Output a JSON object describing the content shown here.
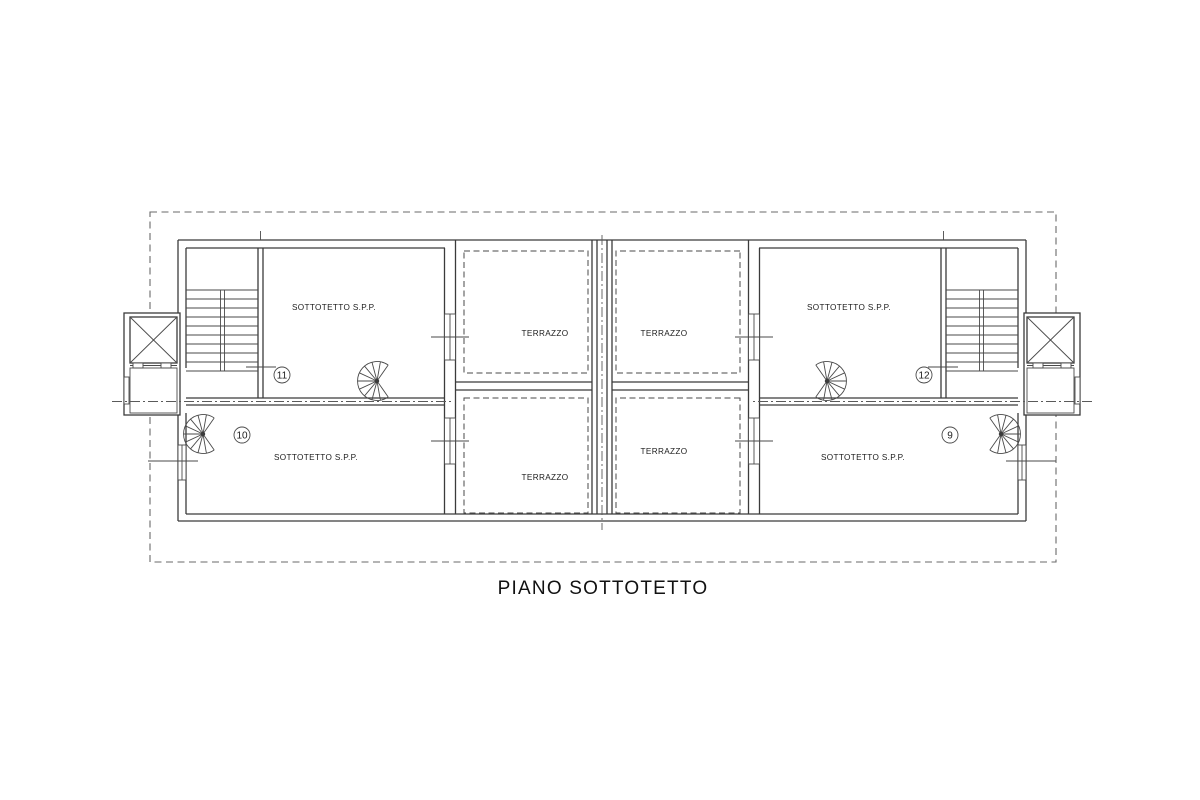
{
  "plan": {
    "title": "PIANO SOTTOTETTO",
    "rooms": {
      "upper_left": {
        "label": "SOTTOTETTO S.P.P.",
        "unit": "11"
      },
      "lower_left": {
        "label": "SOTTOTETTO S.P.P.",
        "unit": "10"
      },
      "upper_right": {
        "label": "SOTTOTETTO S.P.P.",
        "unit": "12"
      },
      "lower_right": {
        "label": "SOTTOTETTO S.P.P.",
        "unit": "9"
      }
    },
    "terraces": {
      "upper_left": "TERRAZZO",
      "upper_right": "TERRAZZO",
      "lower_left": "TERRAZZO",
      "lower_right": "TERRAZZO"
    },
    "colors": {
      "wall_line": "#3b3b3b",
      "thin_line": "#4a4a4a",
      "boundary_dash": "#6a6a6a",
      "text": "#1c1c1c",
      "background": "#ffffff"
    }
  }
}
